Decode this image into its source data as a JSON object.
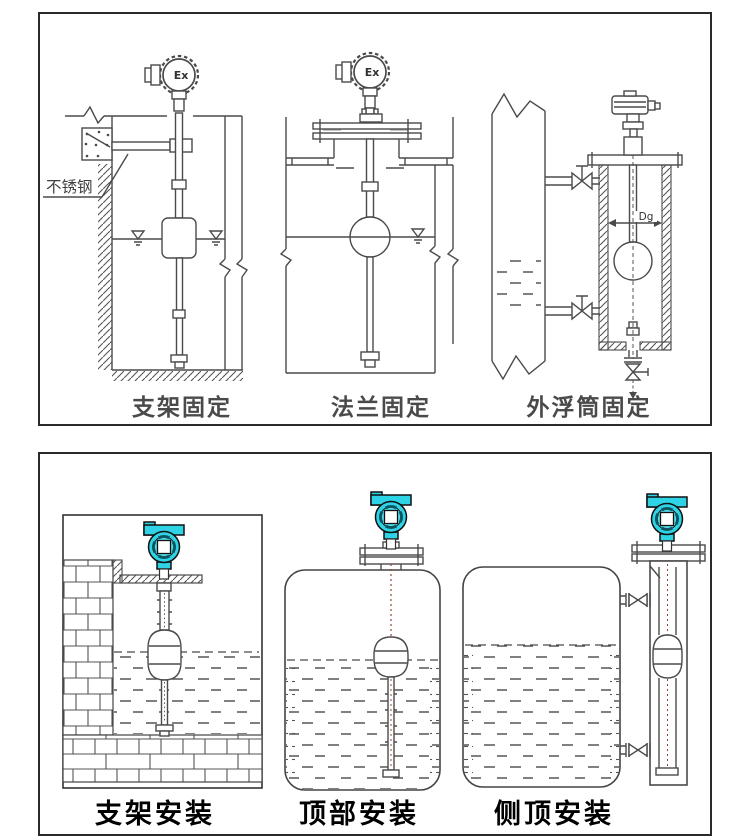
{
  "panels": {
    "top": {
      "captions": [
        {
          "label": "支架固定"
        },
        {
          "label": "法兰固定"
        },
        {
          "label": "外浮筒固定"
        }
      ],
      "labels": {
        "ex_left": "Ex",
        "ex_middle": "Ex",
        "stainless_steel": "不锈钢",
        "diameter": "Dg"
      }
    },
    "bottom": {
      "captions": [
        {
          "label": "支架安装"
        },
        {
          "label": "顶部安装"
        },
        {
          "label": "侧顶安装"
        }
      ]
    }
  },
  "colors": {
    "line": "#4a4a4a",
    "panel_border": "#2a2a2a",
    "transmitter_cyan": "#2fd3e6",
    "cable_red": "#994433",
    "caption_top": "#4a4a4a",
    "caption_bottom": "#000000",
    "background": "#ffffff"
  }
}
